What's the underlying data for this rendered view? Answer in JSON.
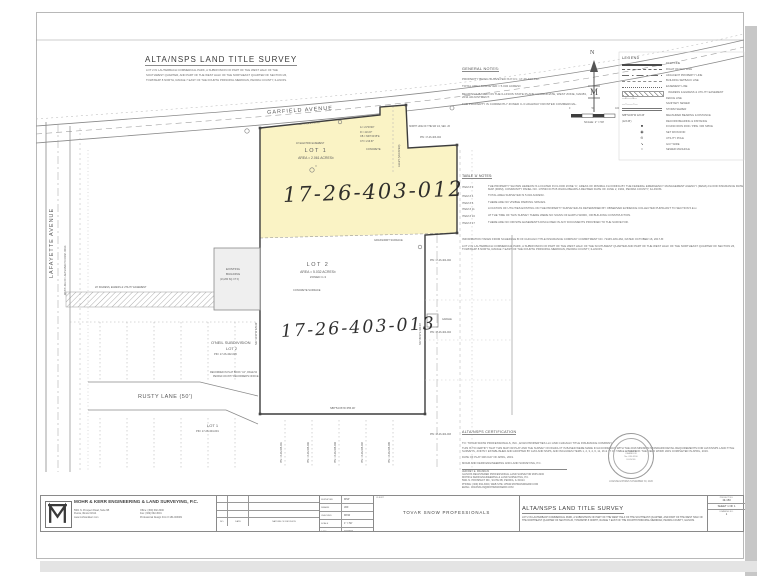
{
  "header": {
    "title": "ALTA/NSPS LAND TITLE SURVEY",
    "description": [
      "LOT 2 IN LAUTERBACH COMMERCIAL PARK, A SUBDIVISION OF PART OF THE WEST HALF OF THE",
      "SOUTHWEST QUARTER, AND PART OF THE WEST HALF OF THE NORTHEAST QUARTER OF SECTION 26,",
      "TOWNSHIP 8 NORTH, RANGE 7 EAST OF THE FOURTH PRINCIPAL MERIDIAN, PEORIA COUNTY, ILLINOIS."
    ]
  },
  "general_notes": {
    "heading": "GENERAL NOTES:",
    "notes": [
      "PROPERTY BEING SURVEYED IS P.I.N.: 17-26-403-012.",
      "TOTAL AREA SURVEYED = 5.032 ACRES±",
      "BEARINGS BASED ON THE ILLINOIS STATE PLANE COORDINATE, WEST ZONE, NAD83, 2011 ADJUSTMENT.",
      "THE PROPERTY IS CURRENTLY ZONED C-3 HIGHWAY FRONTED COMMERCIAL."
    ]
  },
  "compass": {
    "north_label": "N",
    "emblem": "M",
    "scale_ticks": [
      "0",
      "50",
      "100"
    ],
    "scale_label": "SCALE: 1\" = 50'"
  },
  "legend": {
    "heading": "LEGEND",
    "items": [
      {
        "sym": "deed",
        "label": "DEED LINE"
      },
      {
        "sym": "row",
        "label": "RIGHT OF WAY LINE"
      },
      {
        "sym": "adjacent",
        "label": "ADJACENT PROPERTY LINE"
      },
      {
        "sym": "setback",
        "label": "BUILDING SETBACK LINE"
      },
      {
        "sym": "easement",
        "label": "EASEMENT LINE"
      },
      {
        "sym": "ingress",
        "label": "INGRESS & EGRESS & UTILITY EASEMENT"
      },
      {
        "sym": "fence",
        "label": "FENCE LINE"
      },
      {
        "sym": "sanitary",
        "label": "SANITARY SEWER"
      },
      {
        "sym": "storm",
        "label": "STORM SEWER"
      },
      {
        "sym": "measured",
        "sample": "S88°54'26\"W 123.45'",
        "label": "MEASURED BEARING & DISTANCE"
      },
      {
        "sym": "record",
        "sample": "(123.45')",
        "label": "RECORD BEARING & DISTANCE"
      },
      {
        "sym": "found-rod",
        "label": "FOUND IRON ROD / PIPE / RR SPIKE"
      },
      {
        "sym": "set-rod",
        "label": "SET IRON ROD"
      },
      {
        "sym": "utility-pole",
        "label": "UTILITY POLE"
      },
      {
        "sym": "guy-wire",
        "label": "GUY WIRE"
      },
      {
        "sym": "manhole",
        "label": "SEWER MANHOLE"
      }
    ]
  },
  "table_a": {
    "heading": "TABLE 'A' NOTES:",
    "items": [
      {
        "item": "ITEM # 3",
        "text": "THE PROPERTY SHOWN HEREON IS LOCATED IN FLOOD ZONE 'C', AREAS OF MINIMAL FLOODING BY THE FEDERAL EMERGENCY MANAGEMENT AGENCY (FEMA) FLOOD INSURANCE RATE MAP (FIRM), COMMUNITY PANEL NO. 170533 0175 B WHICH BEARS A REVISED DATE OF JUNE 2, 1992, PEORIA COUNTY, ILLINOIS."
      },
      {
        "item": "ITEM # 4",
        "text": "TOTAL AREA SURVEYED IS 5.032 ACRES±."
      },
      {
        "item": "ITEM # 6",
        "text": "THERE ARE NO VISIBLE PARKING SPACES."
      },
      {
        "item": "ITEM # 11",
        "text": "LOCATION OF UTILITIES EXISTING ON THE PROPERTY SURVEYED AS DETERMINED BY OBSERVED EVIDENCE COLLECTED PURSUANT TO SECTION 5.E.iv."
      },
      {
        "item": "ITEM # 16",
        "text": "AT THE TIME OF THIS SURVEY THERE WERE NO SIGNS OF EARTH WORK, OR BUILDING CONSTRUCTION."
      },
      {
        "item": "ITEM # 17",
        "text": "THERE ARE NO OFFSITE EASEMENTS DISCLOSED IN ANY DOCUMENTS PROVIDED TO THE SURVEYOR."
      }
    ]
  },
  "schedule_b": {
    "paragraphs": [
      "INFORMATION TAKEN FROM SCHEDULE B OF CHICAGO TITLE INSURANCE COMPANY COMMITMENT NO. 72445-180-462, DATED OCTOBER 16, 2017-B:",
      "LOT 2 IN LAUTERBACH COMMERCIAL PARK, A SUBDIVISION OF PART OF THE WEST HALF OF THE SOUTHWEST QUARTER AND PART OF THE WEST HALF OF THE NORTHEAST QUARTER OF SECTION 26, TOWNSHIP 8 NORTH, RANGE 7 EAST OF THE FOURTH PRINCIPAL MERIDIAN, PEORIA COUNTY, ILLINOIS."
    ]
  },
  "certification": {
    "heading": "ALTA/NSPS CERTIFICATION",
    "to": "TO: TOVAR SNOW PROFESSIONALS, INC., EVAN PROPERTIES LLC AND CHICAGO TITLE INSURANCE COMPANY",
    "body": "THIS IS TO CERTIFY THAT THIS MAP OR PLAT AND THE SURVEY ON WHICH IT IS BASED WERE MADE IN ACCORDANCE WITH THE 2016 MINIMUM STANDARD DETAIL REQUIREMENTS FOR ALTA/NSPS LAND TITLE SURVEYS, JOINTLY ESTABLISHED AND ADOPTED BY ALTA AND NSPS, AND INCLUDES ITEMS 1, 2, 3, 4, 6, 11, 16 & 17 OF TABLE A THEREOF. THE FIELD WORK WAS COMPLETED IN APRIL, 2019.",
    "date_line": "DATE OF PLAT 30th DAY OF APRIL, 2019.",
    "firm_line": "MOHR AND KERR ENGINEERING AND LAND SURVEYING, P.C.",
    "signature": [
      "JEFFREY E. FRANKLIN",
      "ILLINOIS REGISTERED PROFESSIONAL LAND SURVEYOR #035-3200",
      "MOHR & KERR ENGINEERING & LAND SURVEYING, P.C.",
      "5901 N. PROSPECT RD., SUITE 6B, PEORIA, IL 61614",
      "PHONE: (309) 692-3000, WEB SITE: WWW.MOHRANDKERR.COM",
      "EMAIL: JFRANKLIN@MOHRANDKERR.COM"
    ],
    "seal": {
      "lines": [
        "JEFFREY E.",
        "FRANKLIN",
        "No. 035-3200",
        "ILLINOIS"
      ],
      "license_line": "LICENSE EXPIRES NOVEMBER 30, 2020"
    }
  },
  "survey": {
    "lot1": {
      "name": "LOT 1",
      "area": "AREA = 2.061 ACRES±",
      "symbol": "○",
      "pin_handwritten": "17-26-403-012"
    },
    "lot2": {
      "name": "LOT 2",
      "area": "AREA = 5.032 ACRES±",
      "zoning": "ZONED C-3",
      "pin_handwritten": "17-26-403-013"
    },
    "labels": [
      {
        "t": "GARFIELD AVENUE",
        "x": 267,
        "y": 111,
        "r": -4,
        "s": 5.5,
        "sp": 1
      },
      {
        "t": "LAFAYETTE AVENUE",
        "x": 50,
        "y": 278,
        "r": -90,
        "s": 5.5,
        "sp": 1
      },
      {
        "t": "WEST LINE OF LAUTERBACH COMM. PARK",
        "x": 65,
        "y": 295,
        "r": -90,
        "s": 2.4
      },
      {
        "t": "RUSTY LANE (50')",
        "x": 138,
        "y": 395,
        "s": 5.5,
        "sp": 0.5
      },
      {
        "t": "O'NEIL SUBDIVISION",
        "x": 211,
        "y": 341,
        "s": 4
      },
      {
        "t": "LOT 2",
        "x": 226,
        "y": 347,
        "s": 4
      },
      {
        "t": "PIN: 17-26-402-005",
        "x": 214,
        "y": 354,
        "s": 2.6
      },
      {
        "t": "RECORDED IN PLAT BOOK \"AJ\", PAGE 54",
        "x": 210,
        "y": 372,
        "s": 2.4
      },
      {
        "t": "PEORIA COUNTY RECORDER'S OFFICE",
        "x": 213,
        "y": 376,
        "s": 2.4
      },
      {
        "t": "LOT 1",
        "x": 207,
        "y": 424,
        "s": 4
      },
      {
        "t": "PIN: 17-26-404-001",
        "x": 196,
        "y": 431,
        "s": 2.6
      },
      {
        "t": "EXISTING",
        "x": 226,
        "y": 268,
        "s": 3
      },
      {
        "t": "BUILDING",
        "x": 226,
        "y": 273,
        "s": 3
      },
      {
        "t": "(13,260 SQ. FT.±)",
        "x": 220,
        "y": 279,
        "s": 2.4
      },
      {
        "t": "CONCRETE SURFACE",
        "x": 293,
        "y": 290,
        "s": 2.6
      },
      {
        "t": "GRASS/DIRT SURFACE",
        "x": 374,
        "y": 240,
        "s": 2.6
      },
      {
        "t": "CONCRETE",
        "x": 366,
        "y": 149,
        "s": 2.6
      },
      {
        "t": "ALLEY (VACATED)",
        "x": 399,
        "y": 167,
        "r": -90,
        "s": 2.6
      },
      {
        "t": "NORTH LINE OF THE SW 1/4, SEC. 26",
        "x": 409,
        "y": 126,
        "s": 2.3
      },
      {
        "t": "PIN: 17-26-403-004",
        "x": 420,
        "y": 137,
        "s": 2.4
      },
      {
        "t": "PIN: 17-26-404-002",
        "x": 430,
        "y": 260,
        "s": 2.4
      },
      {
        "t": "GARAGE",
        "x": 442,
        "y": 319,
        "s": 2.3
      },
      {
        "t": "PIN: 17-26-404-004",
        "x": 430,
        "y": 332,
        "s": 2.4
      },
      {
        "t": "PIN: 17-26-405-001",
        "x": 281,
        "y": 463,
        "r": -90,
        "s": 2.4
      },
      {
        "t": "PIN: 17-26-405-002",
        "x": 308,
        "y": 463,
        "r": -90,
        "s": 2.4
      },
      {
        "t": "PIN: 17-26-405-003",
        "x": 335,
        "y": 463,
        "r": -90,
        "s": 2.4
      },
      {
        "t": "PIN: 17-26-405-004",
        "x": 362,
        "y": 463,
        "r": -90,
        "s": 2.4
      },
      {
        "t": "PIN: 17-26-405-005",
        "x": 389,
        "y": 463,
        "r": -90,
        "s": 2.4
      },
      {
        "t": "PIN: 17-26-404-003",
        "x": 430,
        "y": 434,
        "s": 2.4
      },
      {
        "t": "S88°54'26\"W  655.30'",
        "x": 330,
        "y": 408,
        "s": 2.7
      },
      {
        "t": "N88°54'26\"E  197.70'",
        "x": 298,
        "y": 124,
        "r": -5,
        "s": 2.4
      },
      {
        "t": "Δ = 21°03'00\"",
        "x": 360,
        "y": 127,
        "s": 2.4
      },
      {
        "t": "R = 413.97'",
        "x": 360,
        "y": 131.5,
        "s": 2.4
      },
      {
        "t": "CB = N63°34'45\"E",
        "x": 360,
        "y": 136,
        "s": 2.4
      },
      {
        "t": "CH = 219.67'",
        "x": 360,
        "y": 140.5,
        "s": 2.4
      },
      {
        "t": "10' ELECTRIC EASEMENT",
        "x": 296,
        "y": 143,
        "s": 2.3
      },
      {
        "t": "20' INGRESS, EGRESS & UTILITY EASEMENT",
        "x": 95,
        "y": 287,
        "s": 2.4
      },
      {
        "t": "S01°05'34\"E  300.00'",
        "x": 420,
        "y": 345,
        "r": -90,
        "s": 2.4
      },
      {
        "t": "N01°10'34\"W  378.00'",
        "x": 256,
        "y": 345,
        "r": -90,
        "s": 2.4
      }
    ]
  },
  "title_block": {
    "company": {
      "name": "MOHR & KERR ENGINEERING & LAND SURVEYING, P.C.",
      "address": [
        "5901 N. Prospect Road, Suite 6B",
        "Peoria, Illinois 61614",
        "www.mohrandkerr.com"
      ],
      "contact": [
        "Office: (309) 692-3000",
        "Fax: (309) 692-3001",
        "Professional Design Firm # 184-003081"
      ]
    },
    "revisions": {
      "headers": [
        "NO.",
        "DATE",
        "NATURE OF REVISION"
      ]
    },
    "staff": {
      "rows": [
        [
          "SURVEYED",
          "MSP"
        ],
        [
          "DRAWN",
          "JDF"
        ],
        [
          "CHECKED",
          "MKW"
        ],
        [
          "SCALE",
          "1\" = 50'"
        ],
        [
          "DATE",
          "04/2019"
        ]
      ]
    },
    "client": {
      "label": "CLIENT",
      "name": "TOVAR SNOW PROFESSIONALS"
    },
    "survey_title": {
      "title": "ALTA/NSPS LAND TITLE SURVEY",
      "description": "LOT 2 IN LAUTERBACH COMMERCIAL PARK, A SUBDIVISION OF PART OF THE WEST HALF OF THE SOUTHEAST QUARTER, AND PART OF THE WEST HALF OF THE NORTHEAST QUARTER OF SECTION 26, TOWNSHIP 8 NORTH, RANGE 7 EAST OF THE FOURTH PRINCIPAL MERIDIAN, PEORIA COUNTY, ILLINOIS."
    },
    "project": {
      "project_label": "PROJECT NO.",
      "project_no": "19-153",
      "sheet_label": "SHEET 1 OF 1",
      "drawing_label": "DRAWING NO.",
      "drawing_no": "1"
    }
  }
}
